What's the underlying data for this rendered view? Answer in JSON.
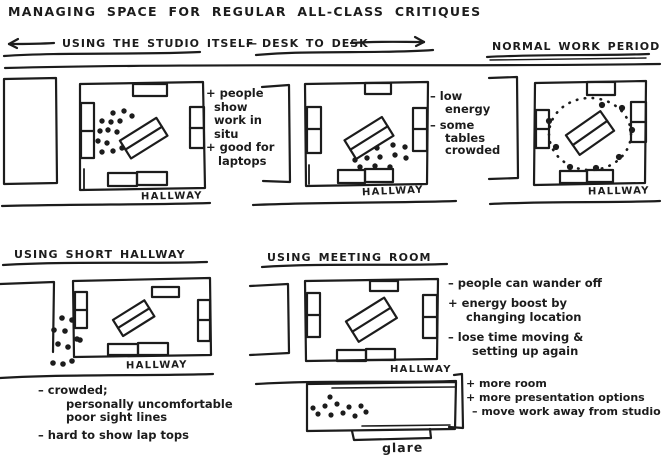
{
  "title": "MANAGING SPACE FOR REGULAR ALL-CLASS CRITIQUES",
  "header": {
    "studio_label": "USING THE STUDIO ITSELF",
    "separator": "—",
    "desk_to_desk_label": "DESK TO DESK",
    "normal_work_label": "NORMAL WORK PERIOD"
  },
  "sections": {
    "short_hallway_title": "USING SHORT HALLWAY",
    "meeting_room_title": "USING MEETING ROOM"
  },
  "hallway_label": "HALLWAY",
  "annotations": {
    "in_situ": {
      "lines": [
        "+ people",
        "show",
        "work in",
        "situ",
        "+ good for",
        "laptops"
      ]
    },
    "desk_to_desk": {
      "lines": [
        "– low",
        "energy",
        "– some",
        "tables",
        "crowded"
      ]
    },
    "short_hallway": {
      "lines": [
        "– crowded;",
        "personally uncomfortable",
        "poor sight lines",
        "– hard to show lap tops"
      ]
    },
    "meeting_room": {
      "lines": [
        "– people can wander off",
        "+ energy boost by",
        "changing location",
        "– lose time moving &",
        "setting up again"
      ]
    },
    "meeting_room_lower": {
      "lines": [
        "+ more room",
        "+ more presentation options",
        "– move work away from studio"
      ]
    },
    "glare_label": "glare"
  },
  "ink_color": "#1c1c1c"
}
